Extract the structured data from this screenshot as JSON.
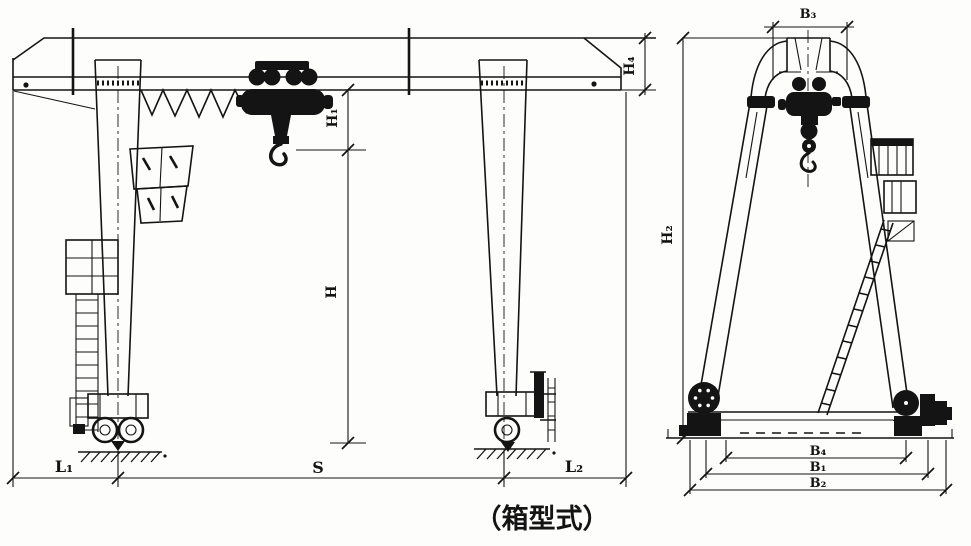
{
  "caption": "（箱型式）",
  "front_view": {
    "labels": {
      "girder_end_height": "H₄",
      "hoist_headroom": "H₁",
      "lifting_height": "H",
      "left_cantilever": "L₁",
      "span": "S",
      "right_cantilever": "L₂"
    }
  },
  "side_view": {
    "labels": {
      "top_width": "B₃",
      "overall_height": "H₂",
      "base_inner_width": "B₄",
      "wheel_base": "B₁",
      "overall_base_width": "B₂"
    }
  }
}
